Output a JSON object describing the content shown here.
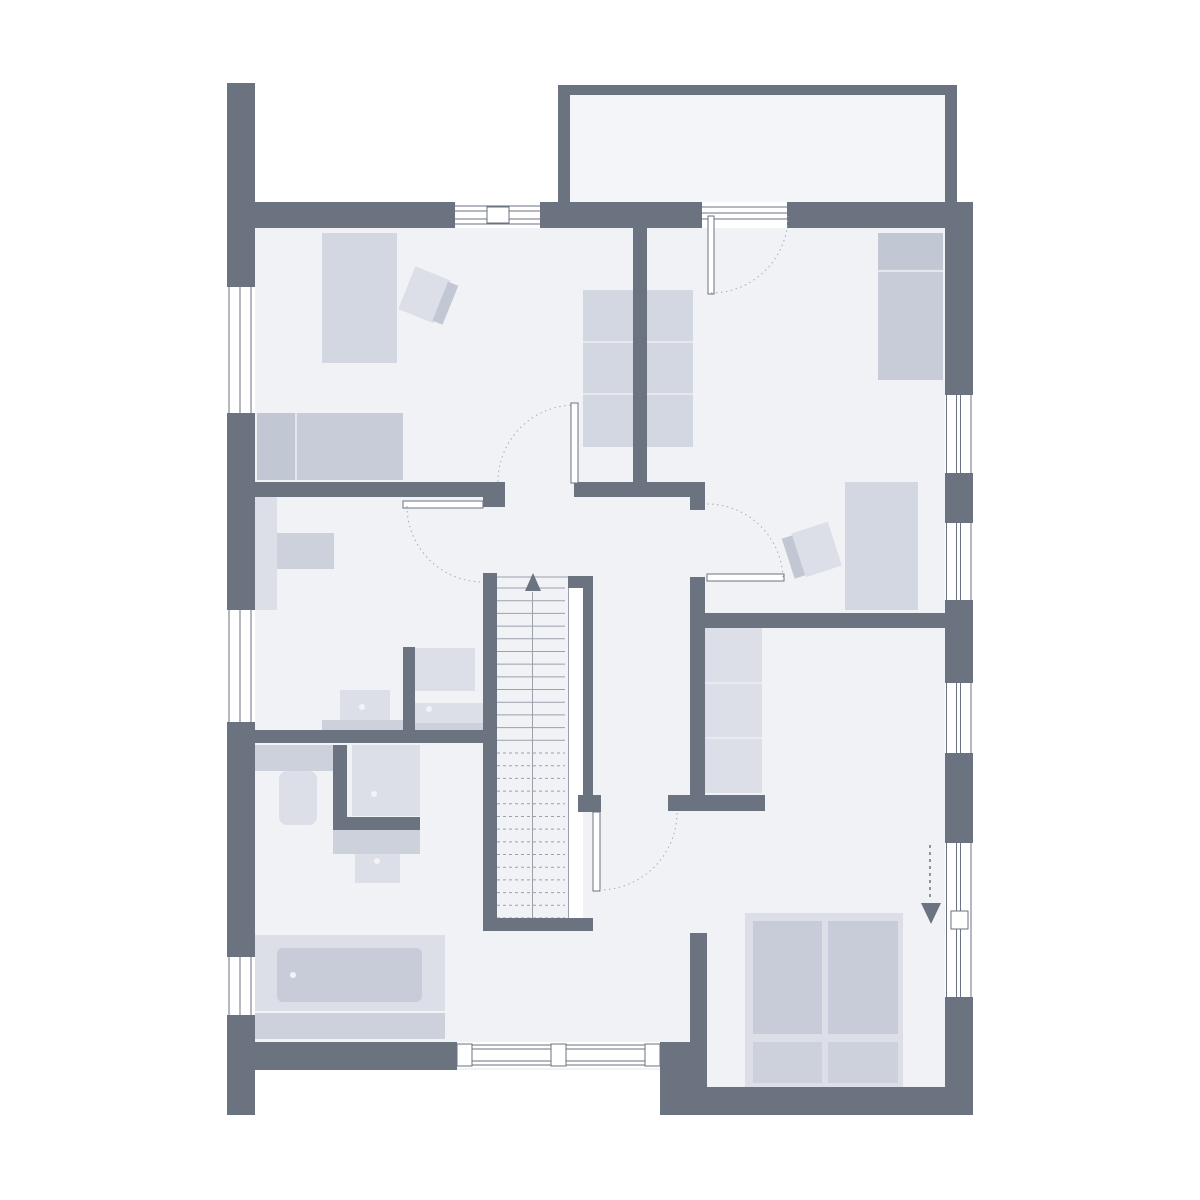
{
  "canvas": {
    "width": 1200,
    "height": 1200,
    "background": "#ffffff"
  },
  "colors": {
    "wall": "#6b7280",
    "floor": "#f1f2f6",
    "balcony_floor": "#f4f5f8",
    "window_line": "#6b7280",
    "window_fill": "#ffffff",
    "arc": "#a6abb7",
    "tread_line": "#9aa0ac",
    "furn_light": "#dcdfe7",
    "furn_light2": "#d3d7e1",
    "furn_med": "#c7ccd8",
    "furn_med2": "#ccd1dc",
    "furn_dark": "#c2c7d4",
    "furn_line": "#edeef3",
    "dot": "#f2f3f7"
  },
  "floors": [
    {
      "name": "floor-main",
      "x": 253,
      "y": 222,
      "w": 692,
      "h": 848
    },
    {
      "name": "floor-bedroom-bottom",
      "x": 690,
      "y": 222,
      "w": 255,
      "h": 865
    },
    {
      "name": "floor-balcony",
      "x": 570,
      "y": 95,
      "w": 375,
      "h": 108,
      "balcony": true
    }
  ],
  "walls": [
    {
      "name": "wall-exterior-west-upper",
      "x": 227,
      "y": 83,
      "w": 28,
      "h": 204
    },
    {
      "name": "wall-exterior-west-mid",
      "x": 227,
      "y": 413,
      "w": 28,
      "h": 197
    },
    {
      "name": "wall-exterior-west-lower",
      "x": 227,
      "y": 722,
      "w": 28,
      "h": 235
    },
    {
      "name": "wall-exterior-west-corner",
      "x": 227,
      "y": 1015,
      "w": 28,
      "h": 100
    },
    {
      "name": "wall-exterior-top-left",
      "x": 250,
      "y": 202,
      "w": 205,
      "h": 26
    },
    {
      "name": "wall-exterior-top-mid",
      "x": 540,
      "y": 202,
      "w": 162,
      "h": 26
    },
    {
      "name": "wall-exterior-top-right",
      "x": 787,
      "y": 202,
      "w": 186,
      "h": 26
    },
    {
      "name": "wall-balcony-top",
      "x": 558,
      "y": 85,
      "w": 392,
      "h": 10
    },
    {
      "name": "wall-balcony-left",
      "x": 558,
      "y": 85,
      "w": 12,
      "h": 120
    },
    {
      "name": "wall-balcony-right",
      "x": 945,
      "y": 85,
      "w": 12,
      "h": 120
    },
    {
      "name": "wall-exterior-right-1",
      "x": 945,
      "y": 203,
      "w": 28,
      "h": 192
    },
    {
      "name": "wall-exterior-right-2",
      "x": 945,
      "y": 473,
      "w": 28,
      "h": 50
    },
    {
      "name": "wall-exterior-right-3",
      "x": 945,
      "y": 600,
      "w": 28,
      "h": 83
    },
    {
      "name": "wall-exterior-right-4",
      "x": 945,
      "y": 753,
      "w": 28,
      "h": 90
    },
    {
      "name": "wall-exterior-right-5",
      "x": 945,
      "y": 997,
      "w": 28,
      "h": 118
    },
    {
      "name": "wall-exterior-bottom-right",
      "x": 668,
      "y": 1087,
      "w": 305,
      "h": 28
    },
    {
      "name": "wall-exterior-bottom-left",
      "x": 227,
      "y": 1042,
      "w": 230,
      "h": 28
    },
    {
      "name": "wall-exterior-bottom-step",
      "x": 660,
      "y": 1042,
      "w": 47,
      "h": 73
    },
    {
      "name": "wall-bedroom-bottom-west",
      "x": 690,
      "y": 933,
      "w": 17,
      "h": 182
    },
    {
      "name": "wall-divider-bedrooms-top",
      "x": 633,
      "y": 222,
      "w": 14,
      "h": 275
    },
    {
      "name": "wall-south-bedrooms-west",
      "x": 243,
      "y": 482,
      "w": 262,
      "h": 15
    },
    {
      "name": "wall-south-bedrooms-east",
      "x": 574,
      "y": 482,
      "w": 131,
      "h": 15
    },
    {
      "name": "wall-door-stub",
      "x": 483,
      "y": 497,
      "w": 22,
      "h": 10
    },
    {
      "name": "wall-corridor-east-upper",
      "x": 690,
      "y": 497,
      "w": 15,
      "h": 13
    },
    {
      "name": "wall-corridor-east",
      "x": 690,
      "y": 577,
      "w": 15,
      "h": 233
    },
    {
      "name": "wall-bedroom2-south",
      "x": 705,
      "y": 613,
      "w": 240,
      "h": 15
    },
    {
      "name": "wall-dressing-south",
      "x": 668,
      "y": 795,
      "w": 97,
      "h": 16
    },
    {
      "name": "wall-stair-cap",
      "x": 578,
      "y": 795,
      "w": 23,
      "h": 17
    },
    {
      "name": "wall-stair-west",
      "x": 483,
      "y": 573,
      "w": 14,
      "h": 358
    },
    {
      "name": "wall-stair-east",
      "x": 583,
      "y": 588,
      "w": 10,
      "h": 207
    },
    {
      "name": "wall-stair-ne-corner",
      "x": 568,
      "y": 576,
      "w": 25,
      "h": 12
    },
    {
      "name": "wall-stair-south",
      "x": 483,
      "y": 918,
      "w": 110,
      "h": 13
    },
    {
      "name": "wall-bath-divider",
      "x": 240,
      "y": 730,
      "w": 243,
      "h": 13
    },
    {
      "name": "wall-bath-niche",
      "x": 403,
      "y": 647,
      "w": 12,
      "h": 96
    },
    {
      "name": "wall-shower-west",
      "x": 333,
      "y": 745,
      "w": 14,
      "h": 85
    },
    {
      "name": "wall-shower-south",
      "x": 333,
      "y": 817,
      "w": 87,
      "h": 13
    }
  ],
  "windows": [
    {
      "name": "window-west-1",
      "x": 227,
      "y": 287,
      "w": 28,
      "h": 126,
      "orient": "v",
      "lines": [
        2,
        13,
        24
      ]
    },
    {
      "name": "window-west-2",
      "x": 227,
      "y": 610,
      "w": 28,
      "h": 112,
      "orient": "v",
      "lines": [
        2,
        13,
        24
      ]
    },
    {
      "name": "window-west-3",
      "x": 227,
      "y": 957,
      "w": 28,
      "h": 58,
      "orient": "v",
      "lines": [
        2,
        13,
        24
      ]
    },
    {
      "name": "window-right-1",
      "x": 945,
      "y": 395,
      "w": 28,
      "h": 78,
      "orient": "v",
      "lines": [
        1.5,
        11.5,
        15.5,
        26
      ]
    },
    {
      "name": "window-right-2",
      "x": 945,
      "y": 523,
      "w": 28,
      "h": 77,
      "orient": "v",
      "lines": [
        1.5,
        11.5,
        15.5,
        26
      ]
    },
    {
      "name": "window-right-3",
      "x": 945,
      "y": 683,
      "w": 28,
      "h": 70,
      "orient": "v",
      "lines": [
        1.5,
        11.5,
        15.5,
        26
      ]
    },
    {
      "name": "window-right-terrace-door",
      "x": 945,
      "y": 843,
      "w": 28,
      "h": 154,
      "orient": "v",
      "lines": [
        1.5,
        11.5,
        15.5,
        26
      ],
      "posts": [
        {
          "x": 951,
          "y": 911,
          "w": 17,
          "h": 18
        }
      ]
    },
    {
      "name": "window-top",
      "x": 455,
      "y": 202,
      "w": 85,
      "h": 26,
      "orient": "h",
      "lines": [
        4,
        9,
        17,
        22
      ],
      "posts": [
        {
          "x": 487,
          "y": 207,
          "w": 22,
          "h": 16
        }
      ]
    },
    {
      "name": "window-top-terrace-threshold",
      "x": 702,
      "y": 202,
      "w": 85,
      "h": 26,
      "orient": "h",
      "lines": [
        5,
        11,
        17
      ]
    },
    {
      "name": "window-bottom",
      "x": 457,
      "y": 1042,
      "w": 203,
      "h": 26,
      "orient": "h",
      "lines": [
        3,
        7,
        19,
        23
      ],
      "posts": [
        {
          "x": 457,
          "y": 1044,
          "w": 15,
          "h": 22
        },
        {
          "x": 551,
          "y": 1044,
          "w": 15,
          "h": 22
        },
        {
          "x": 645,
          "y": 1044,
          "w": 15,
          "h": 22
        }
      ]
    }
  ],
  "doors": [
    {
      "name": "door-bedroom1",
      "leaf": {
        "x": 571,
        "y": 403,
        "w": 7,
        "h": 80
      },
      "arc": "M 498 482 A 77 77 0 0 1 574.5 405"
    },
    {
      "name": "door-bath-north",
      "leaf": {
        "x": 403,
        "y": 501,
        "w": 80,
        "h": 7
      },
      "arc": "M 407 506 A 76 76 0 0 0 483 582"
    },
    {
      "name": "door-balcony",
      "leaf": {
        "x": 708,
        "y": 216,
        "w": 6,
        "h": 78
      },
      "arc": "M 711 293 A 77 77 0 0 0 788 216"
    },
    {
      "name": "door-bedroom2",
      "leaf": {
        "x": 707,
        "y": 574,
        "w": 77,
        "h": 7
      },
      "arc": "M 707 504 A 76 76 0 0 1 783 580"
    },
    {
      "name": "door-hall-south",
      "leaf": {
        "x": 593,
        "y": 812,
        "w": 7,
        "h": 79
      },
      "arc": "M 599 890 A 78 78 0 0 0 677 812"
    }
  ],
  "stairs": {
    "name": "staircase",
    "treadArea": {
      "x": 497,
      "y": 575,
      "w": 71,
      "h": 343
    },
    "voidStrip": {
      "x": 569,
      "y": 576,
      "w": 14,
      "h": 342
    },
    "treadTop": 588,
    "treadBottom": 918,
    "treadCount": 26,
    "dashedBelow": 742,
    "stringerX": 568.5,
    "entryLineY": 577,
    "centerX": 532.5,
    "arrowTriangle": "533,573 525,591 541,591"
  },
  "furniture": [
    {
      "name": "bed-bedroom1",
      "x": 322,
      "y": 233,
      "w": 75,
      "h": 130,
      "fill": "furn_light2"
    },
    {
      "name": "sofa-bed-bedroom1",
      "x": 257,
      "y": 413,
      "w": 146,
      "h": 67,
      "fill": "furn_med",
      "parts": [
        {
          "name": "pillow",
          "x": 257,
          "y": 413,
          "w": 38,
          "h": 67,
          "fill": "furn_dark"
        }
      ],
      "vlines": [
        296
      ]
    },
    {
      "name": "wardrobe-bedroom1",
      "x": 583,
      "y": 290,
      "w": 50,
      "h": 157,
      "fill": "furn_light2",
      "hlines": [
        342,
        394
      ]
    },
    {
      "name": "wardrobe-hall",
      "x": 647,
      "y": 290,
      "w": 46,
      "h": 157,
      "fill": "furn_light2",
      "hlines": [
        342,
        394
      ]
    },
    {
      "name": "bed-bedroom2",
      "x": 878,
      "y": 233,
      "w": 65,
      "h": 147,
      "fill": "furn_med",
      "parts": [
        {
          "name": "pillow",
          "x": 878,
          "y": 233,
          "w": 65,
          "h": 36,
          "fill": "furn_dark"
        }
      ],
      "hlines": [
        271
      ]
    },
    {
      "name": "dresser-bedroom2",
      "x": 845,
      "y": 482,
      "w": 73,
      "h": 128,
      "fill": "furn_light2"
    },
    {
      "name": "shelf-dressing",
      "x": 705,
      "y": 628,
      "w": 57,
      "h": 165,
      "fill": "furn_light",
      "hlines": [
        683,
        738
      ]
    },
    {
      "name": "bed-frame-bedroom3",
      "x": 745,
      "y": 913,
      "w": 158,
      "h": 174,
      "fill": "furn_light"
    },
    {
      "name": "mattress-left",
      "x": 753,
      "y": 921,
      "w": 69,
      "h": 113,
      "fill": "furn_med"
    },
    {
      "name": "mattress-right",
      "x": 828,
      "y": 921,
      "w": 70,
      "h": 113,
      "fill": "furn_med"
    },
    {
      "name": "pillow-left",
      "x": 753,
      "y": 1042,
      "w": 69,
      "h": 41,
      "fill": "furn_med2"
    },
    {
      "name": "pillow-right",
      "x": 828,
      "y": 1042,
      "w": 70,
      "h": 41,
      "fill": "furn_med2"
    },
    {
      "name": "counter-room-west",
      "x": 253,
      "y": 497,
      "w": 24,
      "h": 113,
      "fill": "furn_light"
    },
    {
      "name": "desk-room-west",
      "x": 277,
      "y": 533,
      "w": 57,
      "h": 36,
      "fill": "furn_med2"
    },
    {
      "name": "washbasin-1",
      "x": 340,
      "y": 690,
      "w": 50,
      "h": 31,
      "fill": "furn_light"
    },
    {
      "name": "washbasin-1-counter",
      "x": 322,
      "y": 720,
      "w": 81,
      "h": 12,
      "fill": "furn_med2"
    },
    {
      "name": "cabinet-niche",
      "x": 415,
      "y": 648,
      "w": 60,
      "h": 43,
      "fill": "furn_light"
    },
    {
      "name": "washbasin-2",
      "x": 415,
      "y": 703,
      "w": 68,
      "h": 21,
      "fill": "furn_light"
    },
    {
      "name": "washbasin-2-counter",
      "x": 415,
      "y": 723,
      "w": 68,
      "h": 9,
      "fill": "furn_med2"
    },
    {
      "name": "toilet-tank",
      "x": 255,
      "y": 745,
      "w": 78,
      "h": 26,
      "fill": "furn_med2"
    },
    {
      "name": "toilet-bowl",
      "x": 279,
      "y": 771,
      "w": 38,
      "h": 54,
      "fill": "furn_light",
      "rx": 8
    },
    {
      "name": "shower-pan",
      "x": 352,
      "y": 745,
      "w": 68,
      "h": 71,
      "fill": "furn_light"
    },
    {
      "name": "vanity-counter",
      "x": 333,
      "y": 830,
      "w": 87,
      "h": 24,
      "fill": "furn_med2"
    },
    {
      "name": "vanity-sink",
      "x": 355,
      "y": 854,
      "w": 45,
      "h": 29,
      "fill": "furn_light"
    },
    {
      "name": "bathtub-platform",
      "x": 253,
      "y": 935,
      "w": 192,
      "h": 76,
      "fill": "furn_light"
    },
    {
      "name": "bathtub-inner",
      "x": 277,
      "y": 948,
      "w": 145,
      "h": 54,
      "fill": "furn_med",
      "rx": 6
    },
    {
      "name": "bathtub-mat",
      "x": 253,
      "y": 1013,
      "w": 192,
      "h": 26,
      "fill": "furn_med2"
    }
  ],
  "chairs": [
    {
      "name": "chair-bedroom1",
      "rotate": 22,
      "cx": 430,
      "cy": 297,
      "seat": {
        "x": 405,
        "y": 274,
        "w": 38,
        "h": 46
      },
      "back": {
        "x": 441,
        "y": 276,
        "w": 11,
        "h": 42
      }
    },
    {
      "name": "chair-bedroom2",
      "rotate": -18,
      "cx": 812,
      "cy": 551,
      "seat": {
        "x": 798,
        "y": 528,
        "w": 38,
        "h": 46
      },
      "back": {
        "x": 787,
        "y": 530,
        "w": 11,
        "h": 42
      }
    }
  ],
  "dots": [
    {
      "name": "faucet-washbasin-1",
      "x": 362,
      "y": 707
    },
    {
      "name": "faucet-washbasin-2",
      "x": 429,
      "y": 709
    },
    {
      "name": "drain-shower",
      "x": 374,
      "y": 794
    },
    {
      "name": "faucet-vanity",
      "x": 377,
      "y": 861
    },
    {
      "name": "faucet-bathtub",
      "x": 293,
      "y": 975
    }
  ],
  "entrance_arrow": {
    "name": "entrance-arrow",
    "line": {
      "x1": 930,
      "y1": 845,
      "x2": 930,
      "y2": 901
    },
    "triangle": "921,903 941,903 931,924"
  }
}
